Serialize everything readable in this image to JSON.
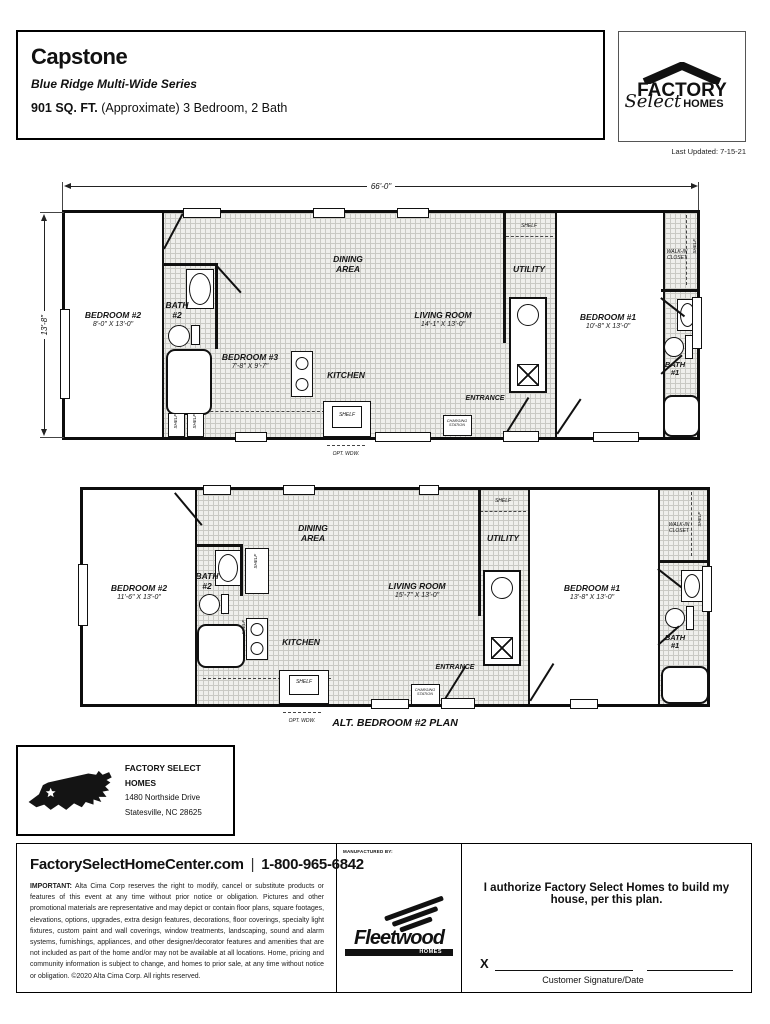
{
  "header": {
    "title": "Capstone",
    "series": "Blue Ridge Multi-Wide Series",
    "sqft": "901 SQ. FT.",
    "sqft_detail": "(Approximate) 3 Bedroom, 2 Bath",
    "last_updated": "Last Updated: 7-15-21"
  },
  "logo": {
    "factory": "FACTORY",
    "select": "Select",
    "homes": "HOMES"
  },
  "plan_main": {
    "width_dim": "66'-0\"",
    "height_dim": "13'-8\"",
    "bedroom2_name": "BEDROOM #2",
    "bedroom2_size": "8'-0\" X 13'-0\"",
    "bath2": "BATH #2",
    "bedroom3_name": "BEDROOM #3",
    "bedroom3_size": "7'-8\" X 9'-7\"",
    "dining": "DINING AREA",
    "kitchen": "KITCHEN",
    "living_name": "LIVING ROOM",
    "living_size": "14'-1\" X 13'-0\"",
    "utility": "UTILITY",
    "entrance": "ENTRANCE",
    "bedroom1_name": "BEDROOM #1",
    "bedroom1_size": "10'-8\" X 13'-0\"",
    "walkin": "WALK-IN CLOSET",
    "bath1": "BATH #1",
    "shelf": "SHELF",
    "charging": "CHARGING STATION",
    "opt_wdw": "OPT. WDW."
  },
  "plan_alt": {
    "caption": "ALT. BEDROOM #2 PLAN",
    "bedroom2_name": "BEDROOM #2",
    "bedroom2_size": "11'-6\" X 13'-0\"",
    "bath2": "BATH #2",
    "dining": "DINING AREA",
    "kitchen": "KITCHEN",
    "living_name": "LIVING ROOM",
    "living_size": "15'-7\" X 13'-0\"",
    "utility": "UTILITY",
    "entrance": "ENTRANCE",
    "bedroom1_name": "BEDROOM #1",
    "bedroom1_size": "13'-8\" X 13'-0\"",
    "walkin": "WALK-IN CLOSET",
    "bath1": "BATH #1",
    "shelf": "SHELF",
    "charging": "CHARGING STATION",
    "opt_wdw": "OPT. WDW."
  },
  "dealer": {
    "name": "FACTORY SELECT HOMES",
    "address1": "1480 Northside Drive",
    "address2": "Statesville, NC 28625"
  },
  "footer": {
    "website": "FactorySelectHomeCenter.com",
    "separator": "|",
    "phone": "1-800-965-6842",
    "important_label": "IMPORTANT:",
    "disclaimer": "Alta Cima Corp reserves the right to modify, cancel or substitute products or features of this event at any time without prior notice or obligation. Pictures and other promotional materials are representative and may depict or contain floor plans, square footages, elevations, options, upgrades, extra design features, decorations, floor coverings, specialty light fixtures, custom paint and wall coverings, window treatments, landscaping, sound and alarm systems, furnishings, appliances, and other designer/decorator features and amenities that are not included as part of the home and/or may not be available at all locations. Home, pricing and community information is subject to change, and homes to prior sale, at any time without notice or obligation. ©2020 Alta Cima Corp. All rights reserved.",
    "manufactured_by": "MANUFACTURED BY:",
    "fleetwood": "Fleetwood",
    "fleetwood_homes": "HOMES",
    "authorize": "I authorize Factory Select Homes to build my house, per this plan.",
    "x_label": "X",
    "signature_label": "Customer Signature/Date"
  }
}
